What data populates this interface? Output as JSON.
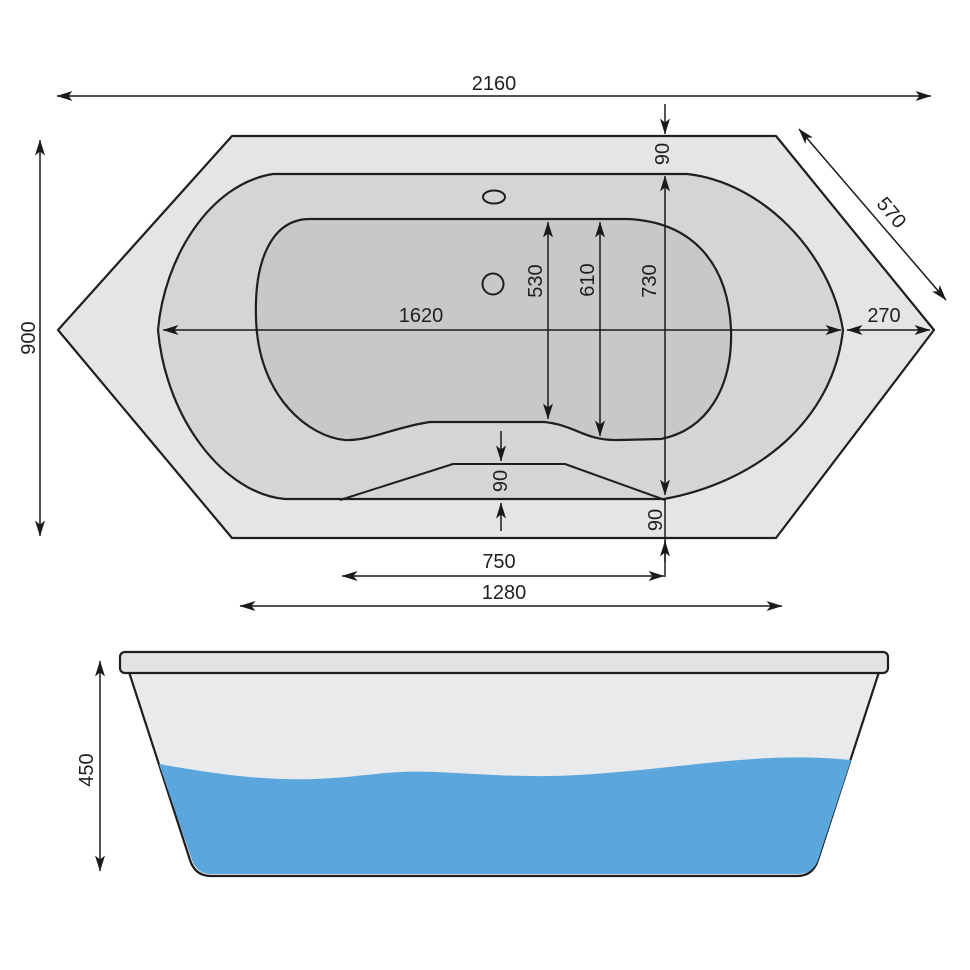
{
  "drawing": {
    "title": "bathtub-dimension-drawing",
    "dims": {
      "overall_length": "2160",
      "overall_width": "900",
      "corner_edge": "570",
      "rim_top": "90",
      "basin_inner_length": "530",
      "basin_outer_length": "610",
      "opening_width": "730",
      "inner_length": "1620",
      "rim_right": "270",
      "seat_rise": "90",
      "rim_bottom": "90",
      "seat_width": "750",
      "bottom_edge": "1280",
      "height": "450"
    },
    "colors": {
      "outer_rim": "#E4E5E7",
      "rim_band": "#D3D5D7",
      "basin": "#C6C8CA",
      "tub_body": "#E9EAEB",
      "rim_slab": "#E2E3E5",
      "water": "#5BA6DC",
      "hole": "#FFFFFF"
    }
  }
}
